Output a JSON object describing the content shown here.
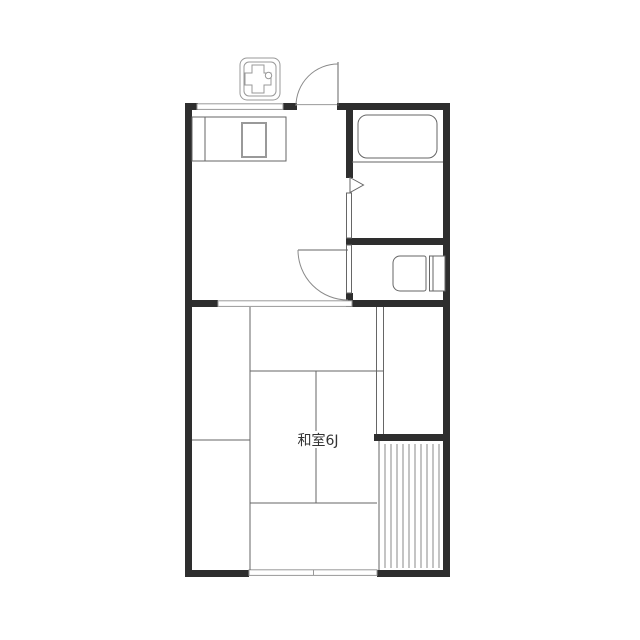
{
  "colors": {
    "background": "#ffffff",
    "wall": "#2e2e2e",
    "line": "#666666",
    "light_line": "#999999",
    "hatch": "#8a8a8a",
    "text": "#333333"
  },
  "rooms": {
    "tatami": {
      "label": "和室6J"
    }
  },
  "fixtures": [
    "gas-stove-icon",
    "kitchen-counter",
    "kitchen-sink",
    "bathtub",
    "toilet"
  ],
  "openings": [
    "entrance-door",
    "bathroom-door",
    "toilet-door",
    "kitchen-window",
    "tatami-sliding-door",
    "tatami-window",
    "closet-sliding-door"
  ],
  "areas": [
    "dining-kitchen",
    "bathroom",
    "toilet-room",
    "tatami-room",
    "closet",
    "balcony"
  ]
}
